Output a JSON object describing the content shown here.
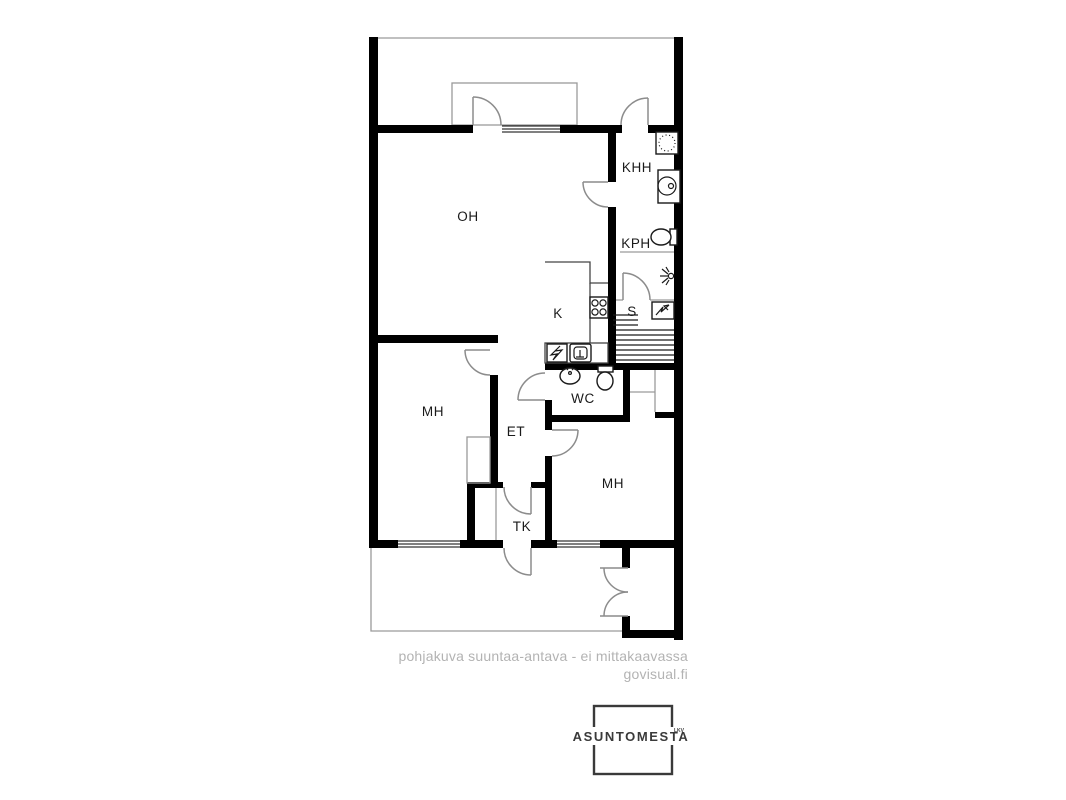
{
  "rooms": {
    "oh": "OH",
    "khh": "KHH",
    "kph": "KPH",
    "k": "K",
    "s": "S",
    "wc": "WC",
    "et": "ET",
    "mh1": "MH",
    "tk": "TK",
    "mh2": "MH"
  },
  "footer": {
    "disclaimer": "pohjakuva suuntaa-antava - ei mittakaavassa",
    "website": "govisual.fi"
  },
  "logo": {
    "brand": "ASUNTOMESTA",
    "suffix": "LKV"
  },
  "icons": [
    "floor-drain-icon",
    "washing-machine-icon",
    "toilet-icon",
    "shower-icon",
    "sauna-stove-icon",
    "sauna-benches-icon",
    "kitchen-stove-icon",
    "kitchen-sink-icon",
    "electrical-panel-icon",
    "wc-sink-icon",
    "wc-toilet-icon",
    "window-icon",
    "door-swing-icon"
  ],
  "colors": {
    "wall": "#000000",
    "thin_line": "#9a9a9a",
    "door": "#8c8c8c",
    "fixture": "#1a1a1a",
    "label": "#1a1a1a",
    "footer_text": "#b3b3b3",
    "logo": "#3a3a3a",
    "background": "#ffffff"
  }
}
